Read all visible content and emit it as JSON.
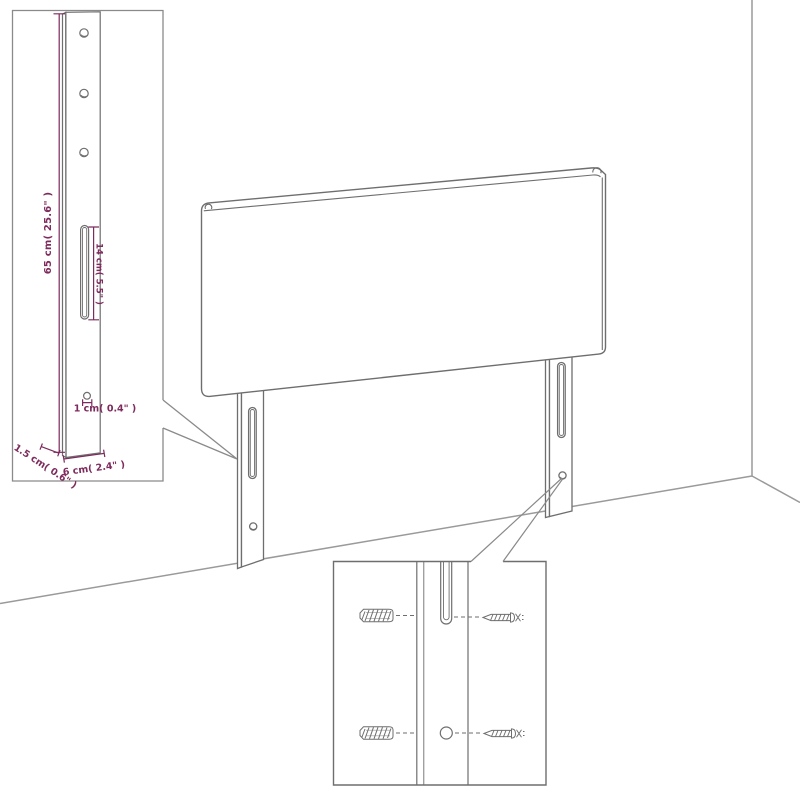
{
  "figure": {
    "kind": "furniture-dimension-diagram",
    "views": {
      "main": "headboard with two mounting legs in room corner",
      "inset_top_left": "leg strut detail with dimensions",
      "inset_bottom": "mounting hardware close-up"
    }
  },
  "colors": {
    "background": "#ffffff",
    "outline": "#6e6e6e",
    "wall_line": "#9a9a9a",
    "inset_border": "#8a8a8a",
    "dimension": "#7d2a5c"
  },
  "labels": {
    "height": "65 cm( 25.6\" )",
    "slot_length": "14 cm( 5.5\" )",
    "hole_diameter": "1 cm( 0.4\" )",
    "depth": "1.5 cm( 0.6\" )",
    "leg_width": "6 cm( 2.4\" )"
  }
}
